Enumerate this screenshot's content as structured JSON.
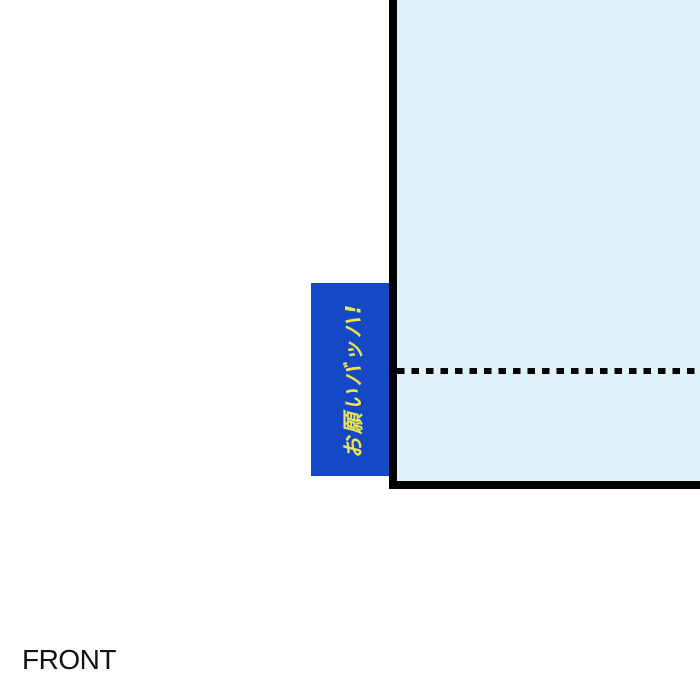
{
  "page": {
    "front_label": "FRONT",
    "background_color": "#ffffff"
  },
  "panel": {
    "fill_color": "#e1f1fa",
    "border_color": "#000000"
  },
  "fold_line": {
    "color": "#000000",
    "style": "dashed"
  },
  "tag": {
    "text": "お願いバッハ!",
    "fill_color": "#1548c4",
    "text_color": "#e9e450"
  }
}
